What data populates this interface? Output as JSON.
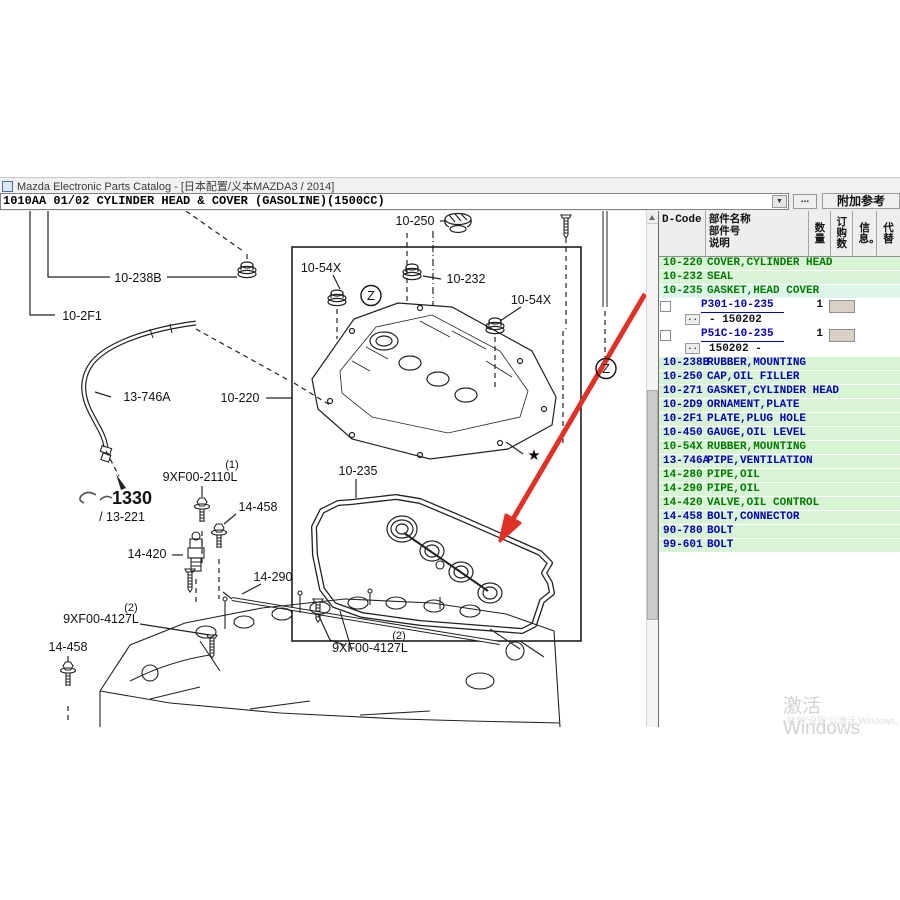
{
  "window": {
    "title": "Mazda Electronic Parts Catalog - [日本配置/义本MAZDA3 / 2014]"
  },
  "icons": {
    "dropdown": "▼",
    "scroll_up": "▲"
  },
  "toolbar": {
    "assembly_code": "1010AA 01/02 CYLINDER HEAD & COVER (GASOLINE)(1500CC)",
    "more_label": "...",
    "reference_label": "附加参考"
  },
  "diagram": {
    "labels": [
      {
        "text": "10-250",
        "x": 415,
        "y": 14
      },
      {
        "text": "10-238B",
        "x": 138,
        "y": 71
      },
      {
        "text": "10-2F1",
        "x": 82,
        "y": 109
      },
      {
        "text": "10-54X",
        "x": 321,
        "y": 61
      },
      {
        "text": "10-232",
        "x": 466,
        "y": 72
      },
      {
        "text": "10-54X",
        "x": 531,
        "y": 93
      },
      {
        "text": "13-746A",
        "x": 147,
        "y": 190
      },
      {
        "text": "10-220",
        "x": 240,
        "y": 191
      },
      {
        "text": "(1)",
        "x": 232,
        "y": 257,
        "size": 11
      },
      {
        "text": "9XF00-2110L",
        "x": 200,
        "y": 270
      },
      {
        "text": "1330",
        "x": 132,
        "y": 293,
        "size": 18,
        "bold": true
      },
      {
        "text": "/ 13-221",
        "x": 122,
        "y": 310
      },
      {
        "text": "14-458",
        "x": 258,
        "y": 300
      },
      {
        "text": "14-420",
        "x": 147,
        "y": 347
      },
      {
        "text": "10-235",
        "x": 358,
        "y": 264
      },
      {
        "text": "14-290",
        "x": 273,
        "y": 370
      },
      {
        "text": "(2)",
        "x": 131,
        "y": 400,
        "size": 11
      },
      {
        "text": "9XF00-4127L",
        "x": 101,
        "y": 412
      },
      {
        "text": "14-458",
        "x": 68,
        "y": 440
      },
      {
        "text": "(2)",
        "x": 399,
        "y": 428,
        "size": 11
      },
      {
        "text": "9XF00-4127L",
        "x": 370,
        "y": 441
      },
      {
        "text": "★",
        "x": 534,
        "y": 249,
        "size": 15,
        "name": "star-footnote"
      },
      {
        "text": "Z",
        "x": 371,
        "y": 89,
        "size": 13,
        "circle": true,
        "name": "view-z-marker"
      },
      {
        "text": "Z",
        "x": 606,
        "y": 162,
        "size": 13,
        "circle": true,
        "name": "view-z-marker"
      }
    ]
  },
  "table": {
    "dots_label": "..",
    "headers": {
      "dcode": "D-Code",
      "name": "部件名称\n部件号\n说明",
      "qty": "数量",
      "order": "订购数",
      "info": "信息。",
      "replace": "代替"
    },
    "rows": [
      {
        "type": "group",
        "code": "10-220",
        "name": "COVER,CYLINDER HEAD",
        "color": "green"
      },
      {
        "type": "group",
        "code": "10-232",
        "name": "SEAL",
        "color": "green"
      },
      {
        "type": "group",
        "code": "10-235",
        "name": "GASKET,HEAD COVER",
        "color": "green",
        "highlight": true
      },
      {
        "type": "part",
        "part_no": "P301-10-235",
        "qty": "1",
        "date_range": "- 150202"
      },
      {
        "type": "part",
        "part_no": "P51C-10-235",
        "qty": "1",
        "date_range": "150202  -"
      },
      {
        "type": "group",
        "code": "10-238B",
        "name": "RUBBER,MOUNTING",
        "color": "blue"
      },
      {
        "type": "group",
        "code": "10-250",
        "name": "CAP,OIL FILLER",
        "color": "blue"
      },
      {
        "type": "group",
        "code": "10-271",
        "name": "GASKET,CYLINDER HEAD",
        "color": "blue"
      },
      {
        "type": "group",
        "code": "10-2D9",
        "name": "ORNAMENT,PLATE",
        "color": "blue"
      },
      {
        "type": "group",
        "code": "10-2F1",
        "name": "PLATE,PLUG HOLE",
        "color": "blue"
      },
      {
        "type": "group",
        "code": "10-450",
        "name": "GAUGE,OIL LEVEL",
        "color": "blue"
      },
      {
        "type": "group",
        "code": "10-54X",
        "name": "RUBBER,MOUNTING",
        "color": "green"
      },
      {
        "type": "group",
        "code": "13-746A",
        "name": "PIPE,VENTILATION",
        "color": "blue"
      },
      {
        "type": "group",
        "code": "14-280",
        "name": "PIPE,OIL",
        "color": "green"
      },
      {
        "type": "group",
        "code": "14-290",
        "name": "PIPE,OIL",
        "color": "green"
      },
      {
        "type": "group",
        "code": "14-420",
        "name": "VALVE,OIL CONTROL",
        "color": "green"
      },
      {
        "type": "group",
        "code": "14-458",
        "name": "BOLT,CONNECTOR",
        "color": "blue"
      },
      {
        "type": "group",
        "code": "90-780",
        "name": "BOLT",
        "color": "blue"
      },
      {
        "type": "group",
        "code": "99-601",
        "name": "BOLT",
        "color": "blue"
      }
    ]
  },
  "watermark": {
    "line1": "激活 Windows",
    "line2": "转到“设置”以激活 Windows。"
  }
}
